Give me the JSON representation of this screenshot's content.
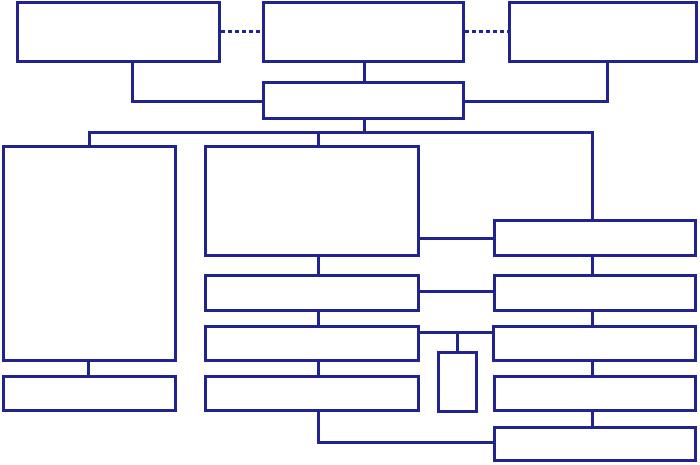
{
  "diagram": {
    "type": "flowchart-template",
    "description": "Blank hierarchical flowchart of empty rectangular boxes connected by solid and dashed navy lines",
    "canvas": {
      "width": 700,
      "height": 465,
      "background": "#ffffff"
    },
    "style": {
      "line_color": "#23238e",
      "line_thickness": 3,
      "box_fill": "#ffffff",
      "dash_length": 4,
      "dash_gap": 3
    },
    "boxes": [
      {
        "id": "box-top-left",
        "x": 16,
        "y": 1,
        "w": 205,
        "h": 62
      },
      {
        "id": "box-top-center",
        "x": 262,
        "y": 1,
        "w": 203,
        "h": 62
      },
      {
        "id": "box-top-right",
        "x": 508,
        "y": 1,
        "w": 190,
        "h": 62
      },
      {
        "id": "box-hub",
        "x": 262,
        "y": 81,
        "w": 203,
        "h": 39
      },
      {
        "id": "box-left-tall",
        "x": 2,
        "y": 145,
        "w": 175,
        "h": 217
      },
      {
        "id": "box-left-footer",
        "x": 2,
        "y": 375,
        "w": 175,
        "h": 37
      },
      {
        "id": "box-center-main",
        "x": 204,
        "y": 145,
        "w": 216,
        "h": 112
      },
      {
        "id": "box-center-row2",
        "x": 204,
        "y": 274,
        "w": 216,
        "h": 38
      },
      {
        "id": "box-center-row3",
        "x": 204,
        "y": 325,
        "w": 216,
        "h": 37
      },
      {
        "id": "box-center-row4",
        "x": 204,
        "y": 375,
        "w": 216,
        "h": 37
      },
      {
        "id": "box-right-row1",
        "x": 493,
        "y": 219,
        "w": 204,
        "h": 38
      },
      {
        "id": "box-right-row2",
        "x": 493,
        "y": 274,
        "w": 204,
        "h": 38
      },
      {
        "id": "box-right-row3",
        "x": 492,
        "y": 325,
        "w": 205,
        "h": 37
      },
      {
        "id": "box-right-row4",
        "x": 493,
        "y": 375,
        "w": 204,
        "h": 37
      },
      {
        "id": "box-right-row5",
        "x": 493,
        "y": 426,
        "w": 204,
        "h": 36
      },
      {
        "id": "box-small-vertical",
        "x": 437,
        "y": 351,
        "w": 41,
        "h": 62
      }
    ],
    "connectors": [
      {
        "id": "connector-dashed-topleft-topcenter",
        "x": 221,
        "y": 30,
        "w": 41,
        "h": 3,
        "style": "dashed"
      },
      {
        "id": "connector-dashed-topcenter-topright",
        "x": 465,
        "y": 30,
        "w": 43,
        "h": 3,
        "style": "dashed"
      },
      {
        "id": "connector-topleft-drop",
        "x": 131,
        "y": 63,
        "w": 3,
        "h": 40,
        "style": "solid"
      },
      {
        "id": "connector-topleft-to-hub",
        "x": 131,
        "y": 100,
        "w": 131,
        "h": 3,
        "style": "solid"
      },
      {
        "id": "connector-topcenter-to-hub",
        "x": 363,
        "y": 63,
        "w": 3,
        "h": 18,
        "style": "solid"
      },
      {
        "id": "connector-topright-drop",
        "x": 606,
        "y": 63,
        "w": 3,
        "h": 40,
        "style": "solid"
      },
      {
        "id": "connector-topright-to-hub",
        "x": 465,
        "y": 100,
        "w": 144,
        "h": 3,
        "style": "solid"
      },
      {
        "id": "connector-hub-to-bus",
        "x": 363,
        "y": 120,
        "w": 3,
        "h": 14,
        "style": "solid"
      },
      {
        "id": "connector-bus",
        "x": 88,
        "y": 131,
        "w": 506,
        "h": 3,
        "style": "solid"
      },
      {
        "id": "connector-bus-to-left-tall",
        "x": 88,
        "y": 131,
        "w": 3,
        "h": 15,
        "style": "solid"
      },
      {
        "id": "connector-bus-to-center-main",
        "x": 317,
        "y": 131,
        "w": 3,
        "h": 15,
        "style": "solid"
      },
      {
        "id": "connector-bus-to-right-row1",
        "x": 591,
        "y": 131,
        "w": 3,
        "h": 88,
        "style": "solid"
      },
      {
        "id": "connector-left-tall-to-footer",
        "x": 87,
        "y": 362,
        "w": 3,
        "h": 13,
        "style": "solid"
      },
      {
        "id": "connector-center-main-to-row2",
        "x": 317,
        "y": 257,
        "w": 3,
        "h": 17,
        "style": "solid"
      },
      {
        "id": "connector-center-row2-to-row3",
        "x": 317,
        "y": 312,
        "w": 3,
        "h": 13,
        "style": "solid"
      },
      {
        "id": "connector-center-row3-to-row4",
        "x": 317,
        "y": 362,
        "w": 3,
        "h": 13,
        "style": "solid"
      },
      {
        "id": "connector-centermain-to-right1",
        "x": 420,
        "y": 237,
        "w": 73,
        "h": 3,
        "style": "solid"
      },
      {
        "id": "connector-centerrow2-to-right2",
        "x": 420,
        "y": 290,
        "w": 73,
        "h": 3,
        "style": "solid"
      },
      {
        "id": "connector-centerrow3-to-right3",
        "x": 420,
        "y": 331,
        "w": 72,
        "h": 3,
        "style": "solid"
      },
      {
        "id": "connector-smallbox-stub",
        "x": 456,
        "y": 331,
        "w": 3,
        "h": 20,
        "style": "solid"
      },
      {
        "id": "connector-right1-to-right2",
        "x": 591,
        "y": 257,
        "w": 3,
        "h": 17,
        "style": "solid"
      },
      {
        "id": "connector-right2-to-right3",
        "x": 591,
        "y": 312,
        "w": 3,
        "h": 13,
        "style": "solid"
      },
      {
        "id": "connector-right3-to-right4",
        "x": 591,
        "y": 362,
        "w": 3,
        "h": 13,
        "style": "solid"
      },
      {
        "id": "connector-right4-to-right5",
        "x": 591,
        "y": 412,
        "w": 3,
        "h": 14,
        "style": "solid"
      },
      {
        "id": "connector-centerrow4-drop",
        "x": 317,
        "y": 412,
        "w": 3,
        "h": 32,
        "style": "solid"
      },
      {
        "id": "connector-centerrow4-to-right5",
        "x": 317,
        "y": 441,
        "w": 176,
        "h": 3,
        "style": "solid"
      }
    ]
  }
}
